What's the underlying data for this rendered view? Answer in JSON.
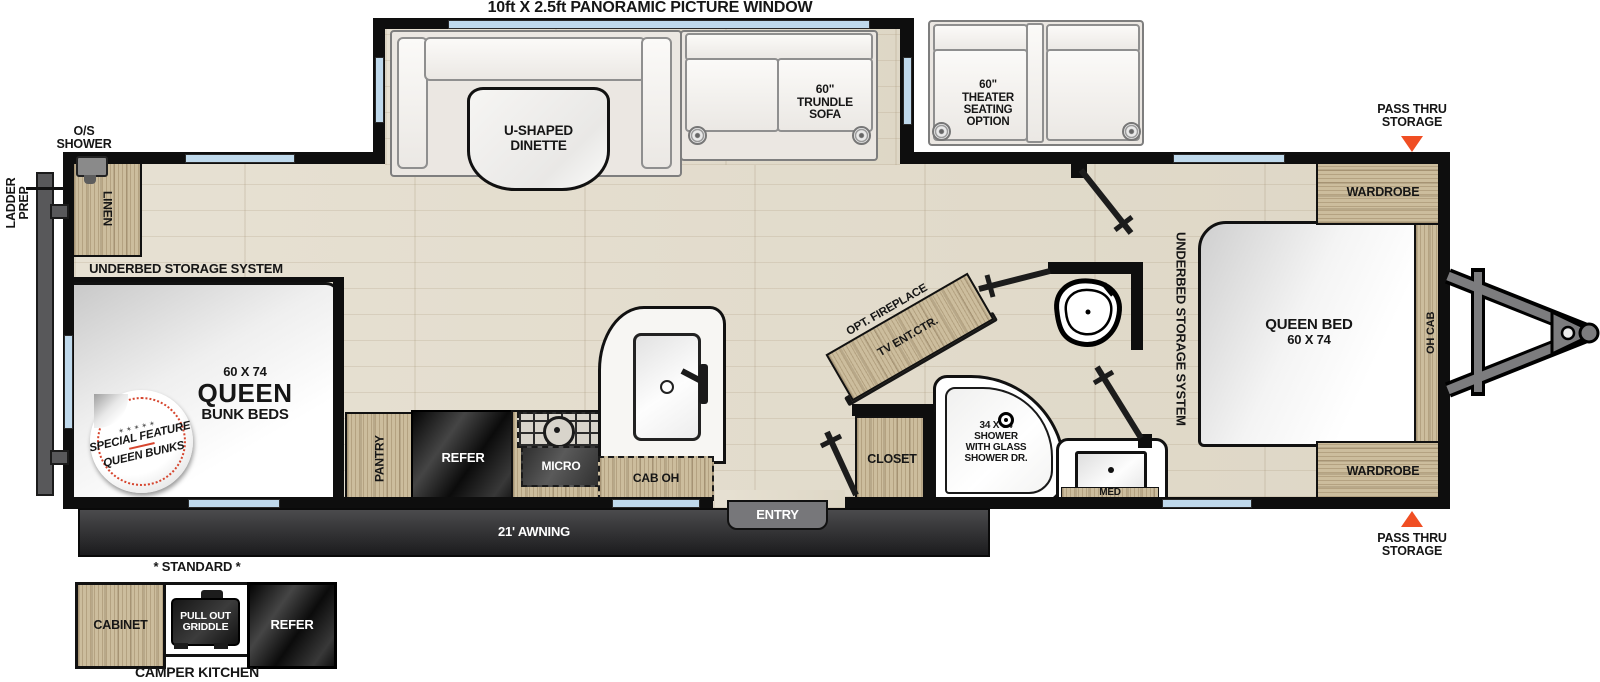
{
  "colors": {
    "accent_orange": "#F04E23",
    "window_blue": "#BFD9EC",
    "wall_black": "#0E0E0E",
    "wood_tan": "#CCBD9D",
    "floor_beige": "#E4DDCF",
    "appliance_dark": "#1E1E1E",
    "badge_red": "#D6452E"
  },
  "title": "10ft X 2.5ft PANORAMIC PICTURE WINDOW",
  "slideout": {
    "dinette_l1": "U-SHAPED",
    "dinette_l2": "DINETTE",
    "trundle_l1": "60\"",
    "trundle_l2": "TRUNDLE",
    "trundle_l3": "SOFA"
  },
  "theater": {
    "l1": "60\"",
    "l2": "THEATER",
    "l3": "SEATING",
    "l4": "OPTION"
  },
  "exterior": {
    "os_shower_l1": "O/S",
    "os_shower_l2": "SHOWER",
    "ladder_l1": "LADDER",
    "ladder_l2": "PREP",
    "awning": "21' AWNING",
    "entry": "ENTRY",
    "pass_thru_l1": "PASS THRU",
    "pass_thru_l2": "STORAGE"
  },
  "bunk_room": {
    "underbed": "UNDERBED STORAGE SYSTEM",
    "linen": "LINEN",
    "size": "60 X 74",
    "name": "QUEEN",
    "type": "BUNK BEDS",
    "badge_stars": "✶✶✶✶✶",
    "badge_l1": "SPECIAL FEATURE",
    "badge_l2": "QUEEN BUNKS"
  },
  "kitchen": {
    "pantry": "PANTRY",
    "refer": "REFER",
    "micro": "MICRO",
    "cab_oh": "CAB OH"
  },
  "bath": {
    "fireplace": "OPT. FIREPLACE",
    "tv": "TV ENT.CTR.",
    "closet": "CLOSET",
    "shower_l1": "34 X 34",
    "shower_l2": "SHOWER",
    "shower_l3": "WITH GLASS",
    "shower_l4": "SHOWER DR.",
    "med": "MED"
  },
  "bedroom": {
    "underbed": "UNDERBED STORAGE SYSTEM",
    "bed_l1": "QUEEN BED",
    "bed_l2": "60 X 74",
    "oh_cab": "OH CAB",
    "wardrobe_front": "WARDROBE",
    "wardrobe_rear": "WARDROBE"
  },
  "camper_kitchen": {
    "standard": "* STANDARD *",
    "cabinet": "CABINET",
    "griddle_l1": "PULL OUT",
    "griddle_l2": "GRIDDLE",
    "refer": "REFER",
    "title": "CAMPER KITCHEN"
  }
}
